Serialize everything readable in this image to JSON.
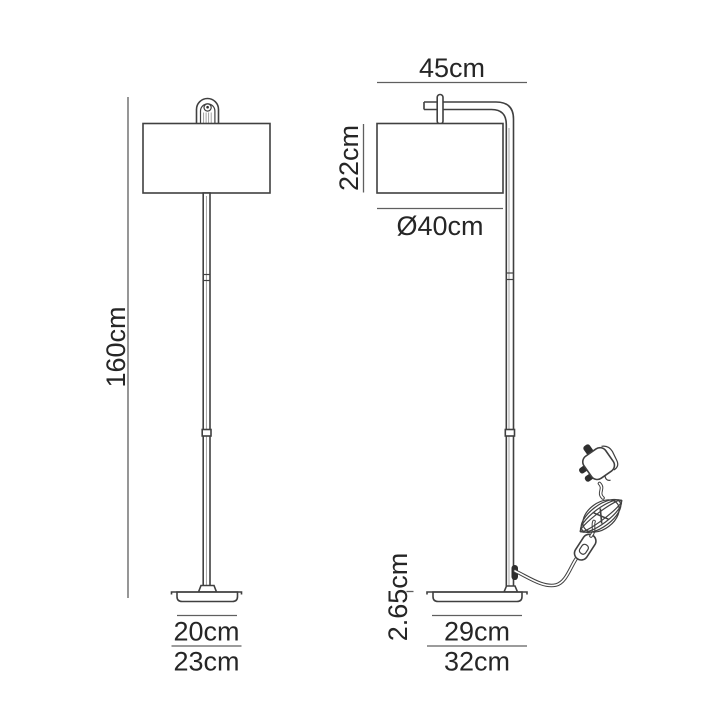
{
  "colors": {
    "background": "#ffffff",
    "drawing_line": "#404040",
    "dimension_line": "#5f5f5f",
    "label_text": "#262626"
  },
  "front_view": {
    "height": "160cm",
    "base_width_inner": "20cm",
    "base_width_outer": "23cm"
  },
  "side_view": {
    "depth": "45cm",
    "shade_height": "22cm",
    "shade_diameter": "Ø40cm",
    "base_thickness": "2.65cm",
    "base_depth_inner": "29cm",
    "base_depth_outer": "32cm"
  }
}
